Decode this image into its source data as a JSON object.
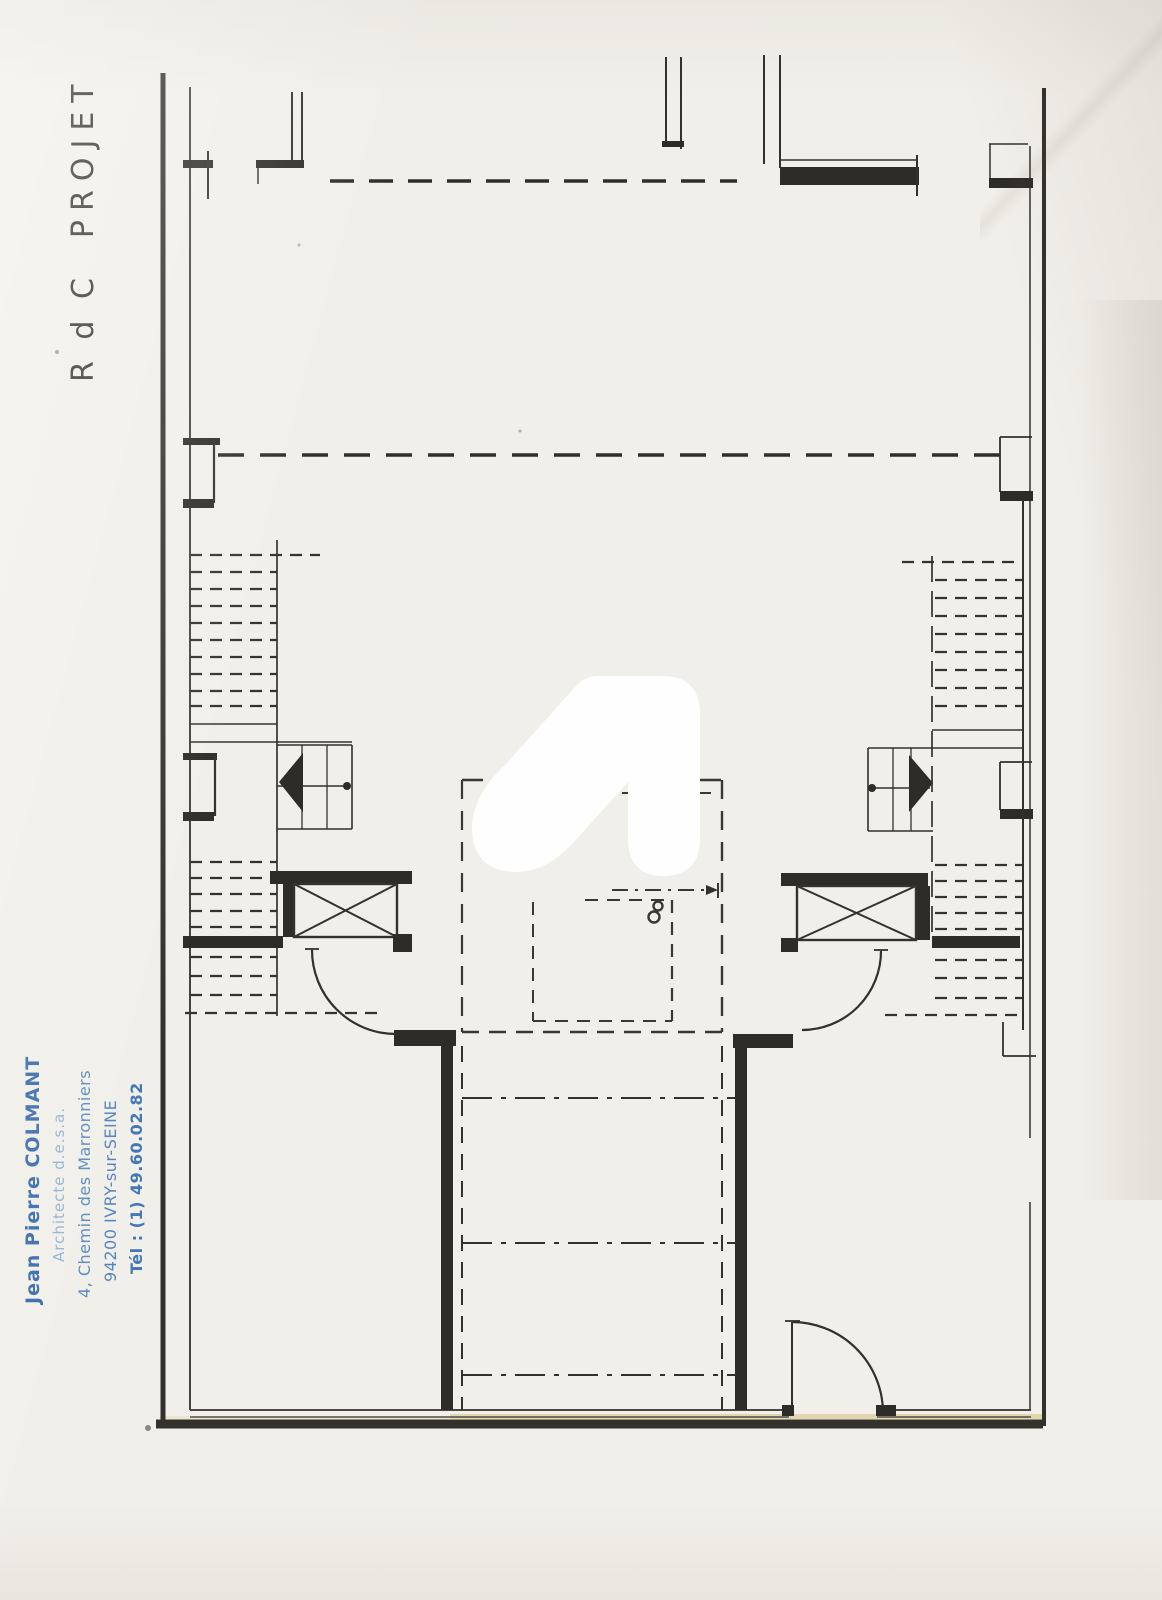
{
  "annotations": {
    "floor_label": "R d C",
    "project_label": "PROJET"
  },
  "stamp": {
    "lines": [
      "Jean Pierre COLMANT",
      "Architecte d.e.s.a.",
      "4, Chemin des Marronniers",
      "94200 IVRY-sur-SEINE",
      "Tél : (1) 49.60.02.82"
    ],
    "color_primary": "#3a6cab",
    "color_secondary": "#5d8cc2"
  },
  "colors": {
    "paper": "#f1efe9",
    "drawing_ink": "#33312c",
    "watermark": "#fefefe"
  },
  "drawing_kind": "floor-plan"
}
